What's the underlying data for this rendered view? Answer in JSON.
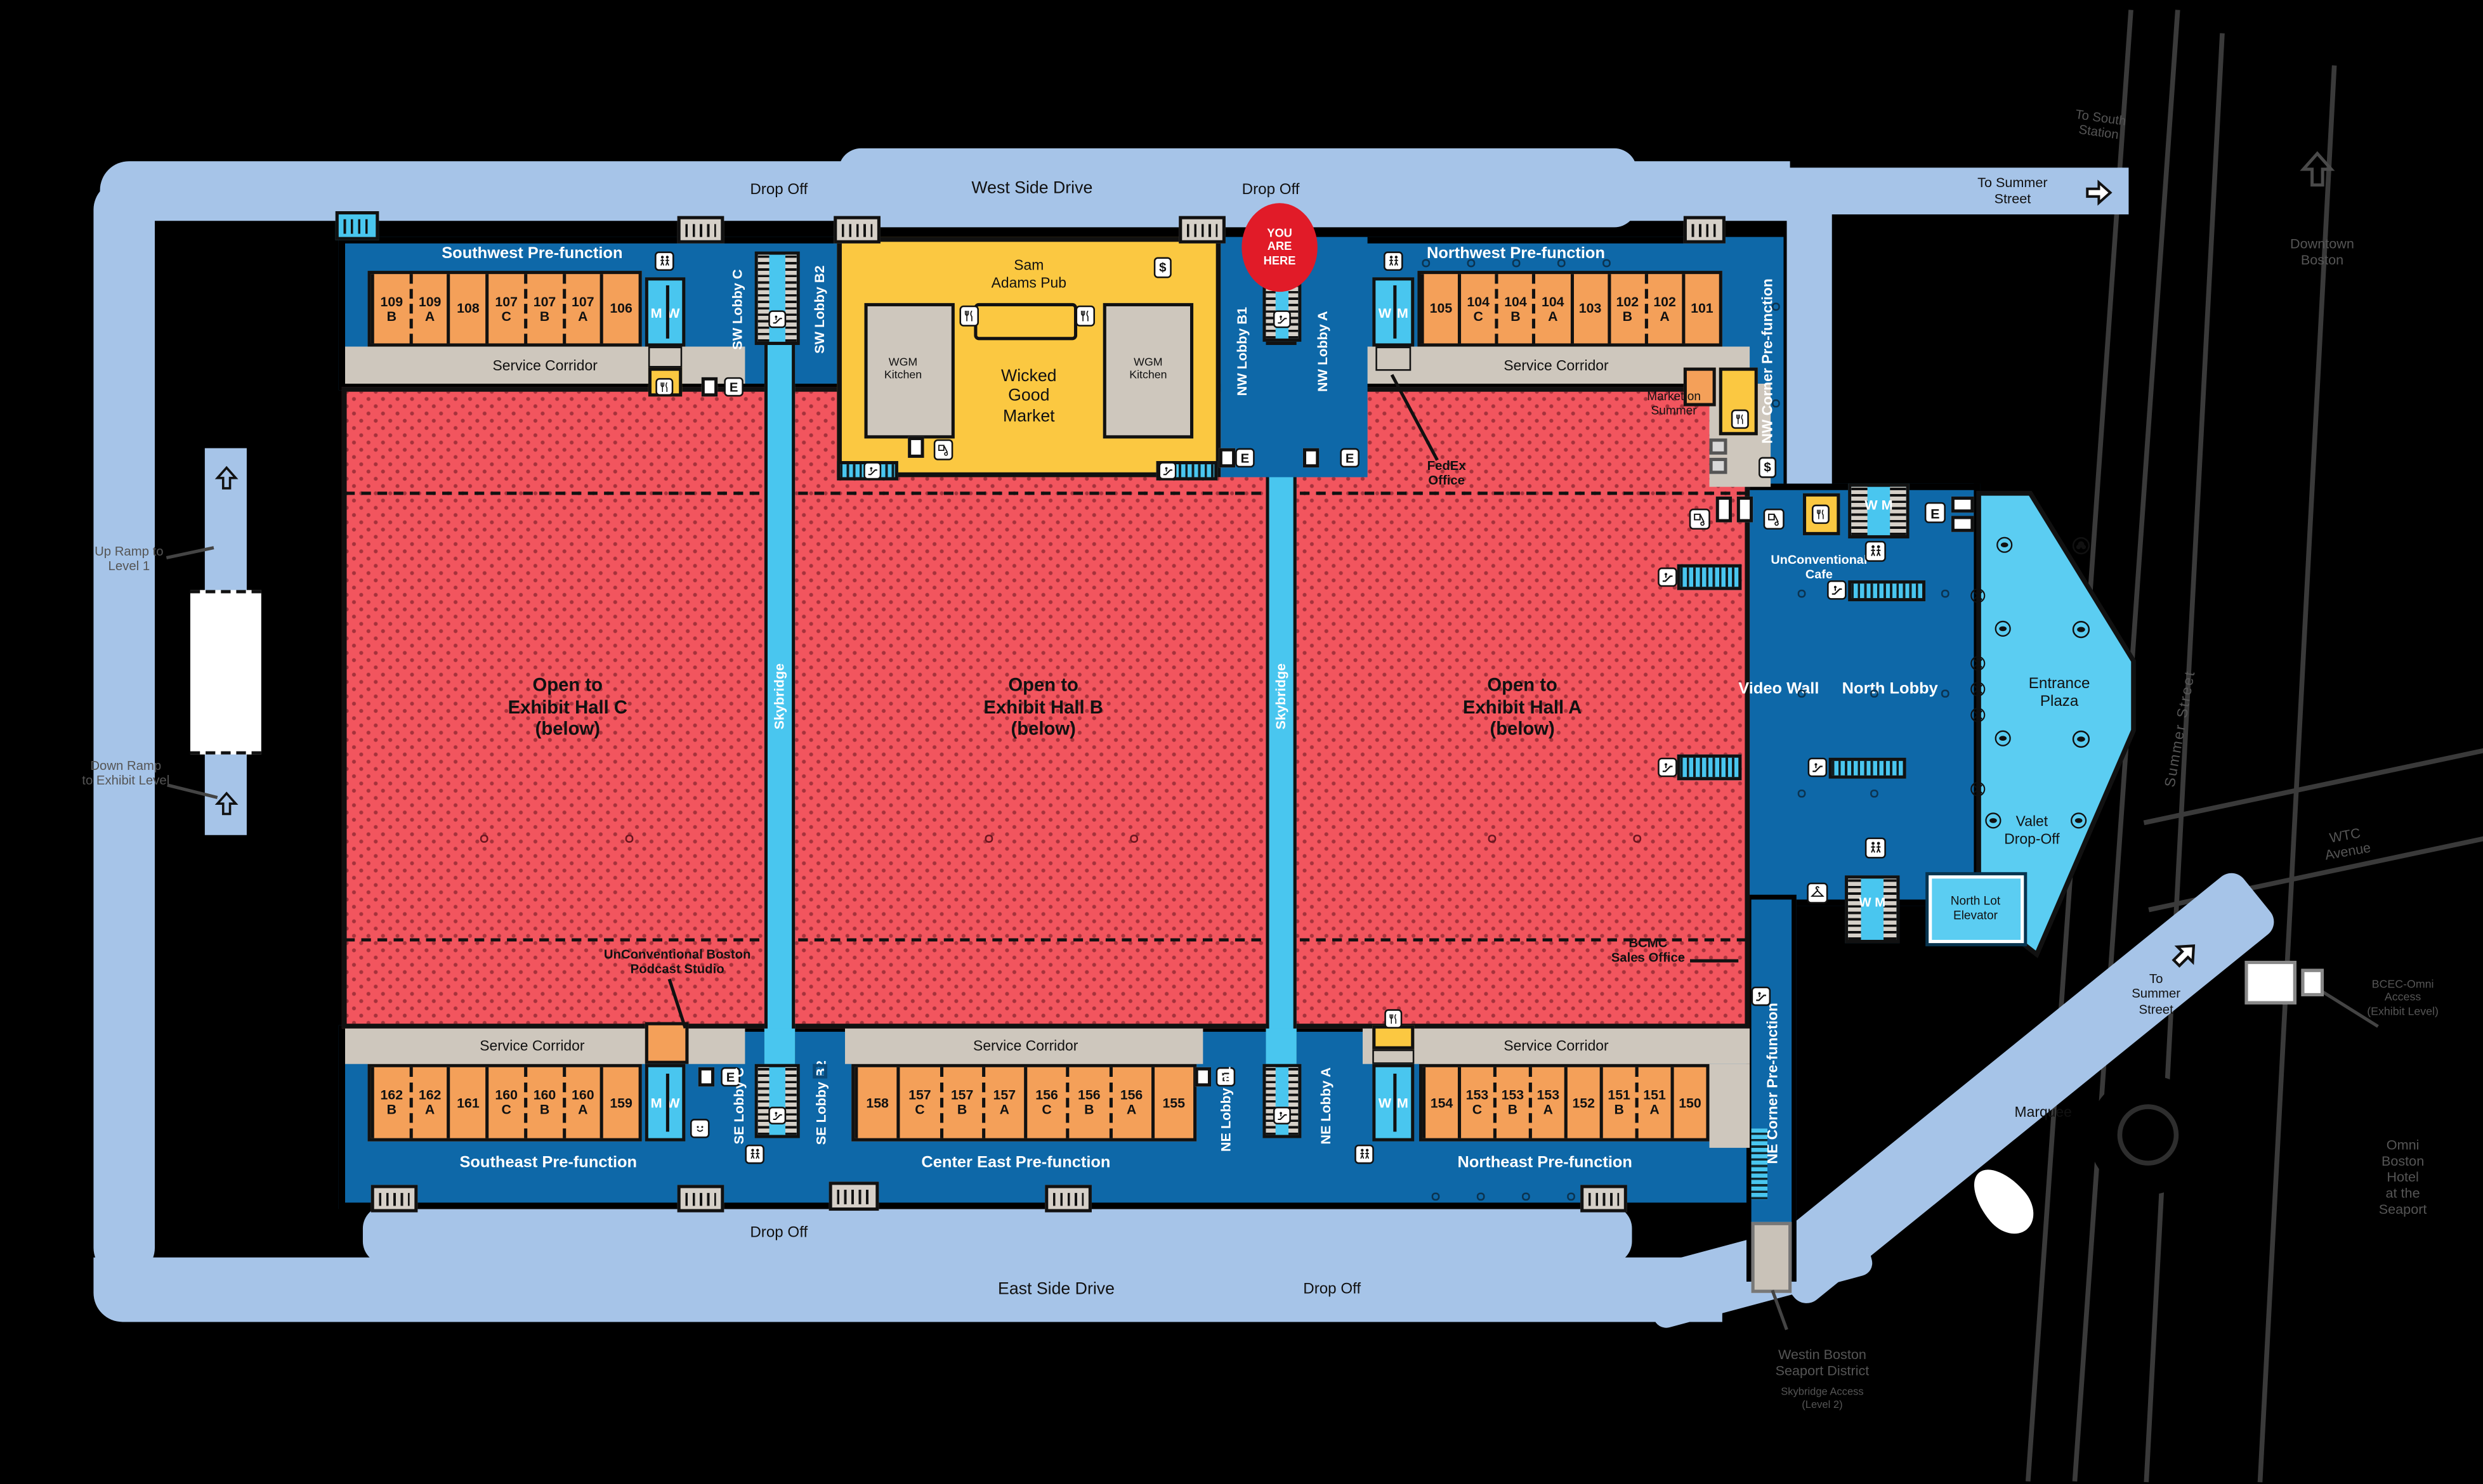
{
  "roads": {
    "west_side_drive": "West Side Drive",
    "east_side_drive": "East Side Drive",
    "drop_off": "Drop Off",
    "to_summer_street": [
      "To Summer",
      "Street"
    ],
    "to_summer_street_lower": [
      "To",
      "Summer",
      "Street"
    ],
    "to_south_station": [
      "To South",
      "Station"
    ],
    "downtown_boston": [
      "Downtown",
      "Boston"
    ],
    "summer_street": "Summer Street",
    "wtc_avenue": [
      "WTC",
      "Avenue"
    ],
    "marquee": "Marquee"
  },
  "ramps": {
    "up": [
      "Up Ramp to",
      "Level 1"
    ],
    "down": [
      "Down Ramp",
      "to Exhibit Level"
    ]
  },
  "prefunction": {
    "sw": "Southwest Pre-function",
    "nw": "Northwest Pre-function",
    "se": "Southeast Pre-function",
    "ce": "Center East Pre-function",
    "ne": "Northeast Pre-function",
    "nw_corner": "NW Corner Pre-function",
    "ne_corner": "NE Corner Pre-function"
  },
  "service_corridor": "Service Corridor",
  "lobbies": {
    "sw_c": "SW Lobby C",
    "sw_b2": "SW Lobby B2",
    "nw_b1": "NW Lobby B1",
    "nw_a": "NW Lobby A",
    "se_c": "SE Lobby C",
    "se_b2": "SE Lobby B2",
    "ne_b1": "NE Lobby B1",
    "ne_a": "NE Lobby A",
    "north": "North Lobby"
  },
  "skybridge": "Skybridge",
  "halls": {
    "c": [
      "Open to",
      "Exhibit Hall C",
      "(below)"
    ],
    "b": [
      "Open to",
      "Exhibit Hall B",
      "(below)"
    ],
    "a": [
      "Open to",
      "Exhibit Hall A",
      "(below)"
    ]
  },
  "venues": {
    "sam_adams": [
      "Sam",
      "Adams Pub"
    ],
    "wicked": [
      "Wicked",
      "Good",
      "Market"
    ],
    "wgm_kitchen": [
      "WGM",
      "Kitchen"
    ],
    "market_on_summer": [
      "Market on",
      "Summer"
    ],
    "unconventional_cafe": [
      "UnConventional",
      "Cafe"
    ],
    "podcast": [
      "UnConventional Boston",
      "Podcast Studio"
    ],
    "fedex": [
      "FedEx",
      "Office"
    ],
    "bcmc": [
      "BCMC",
      "Sales Office"
    ],
    "video_wall": "Video Wall",
    "entrance_plaza": [
      "Entrance",
      "Plaza"
    ],
    "valet": [
      "Valet",
      "Drop-Off"
    ],
    "north_lot": [
      "North Lot",
      "Elevator"
    ],
    "you_are_here": [
      "YOU",
      "ARE",
      "HERE"
    ]
  },
  "outside": {
    "westin": [
      "Westin Boston",
      "Seaport District"
    ],
    "westin_sub": [
      "Skybridge Access",
      "(Level 2)"
    ],
    "omni": [
      "Omni",
      "Boston",
      "Hotel",
      "at the",
      "Seaport"
    ],
    "bcec_omni": [
      "BCEC-Omni",
      "Access",
      "(Exhibit Level)"
    ]
  },
  "letters": {
    "m": "M",
    "w": "W",
    "e": "E",
    "dollar": "$"
  },
  "rooms": {
    "sw": [
      {
        "n": "109",
        "l": "B"
      },
      {
        "n": "109",
        "l": "A",
        "d": 1
      },
      {
        "n": "108"
      },
      {
        "n": "107",
        "l": "C"
      },
      {
        "n": "107",
        "l": "B",
        "d": 1
      },
      {
        "n": "107",
        "l": "A",
        "d": 1
      },
      {
        "n": "106"
      }
    ],
    "nw": [
      {
        "n": "105"
      },
      {
        "n": "104",
        "l": "C"
      },
      {
        "n": "104",
        "l": "B",
        "d": 1
      },
      {
        "n": "104",
        "l": "A",
        "d": 1
      },
      {
        "n": "103"
      },
      {
        "n": "102",
        "l": "B"
      },
      {
        "n": "102",
        "l": "A",
        "d": 1
      },
      {
        "n": "101"
      }
    ],
    "se": [
      {
        "n": "162",
        "l": "B"
      },
      {
        "n": "162",
        "l": "A",
        "d": 1
      },
      {
        "n": "161"
      },
      {
        "n": "160",
        "l": "C"
      },
      {
        "n": "160",
        "l": "B",
        "d": 1
      },
      {
        "n": "160",
        "l": "A",
        "d": 1
      },
      {
        "n": "159"
      }
    ],
    "ce": [
      {
        "n": "158"
      },
      {
        "n": "157",
        "l": "C"
      },
      {
        "n": "157",
        "l": "B",
        "d": 1
      },
      {
        "n": "157",
        "l": "A",
        "d": 1
      },
      {
        "n": "156",
        "l": "C"
      },
      {
        "n": "156",
        "l": "B",
        "d": 1
      },
      {
        "n": "156",
        "l": "A",
        "d": 1
      },
      {
        "n": "155"
      }
    ],
    "ne": [
      {
        "n": "154"
      },
      {
        "n": "153",
        "l": "C"
      },
      {
        "n": "153",
        "l": "B",
        "d": 1
      },
      {
        "n": "153",
        "l": "A",
        "d": 1
      },
      {
        "n": "152"
      },
      {
        "n": "151",
        "l": "B"
      },
      {
        "n": "151",
        "l": "A",
        "d": 1
      },
      {
        "n": "150"
      }
    ]
  },
  "colors": {
    "road": "#A6C4E8",
    "building": "#0E68A8",
    "cyan": "#49C6EF",
    "plaza": "#5BCDF2",
    "orange": "#F4A059",
    "hall_red": "#F2555E",
    "corridor": "#CEC7BD",
    "yellow": "#FBC841",
    "here_red": "#E11B28",
    "background": "#000000"
  }
}
